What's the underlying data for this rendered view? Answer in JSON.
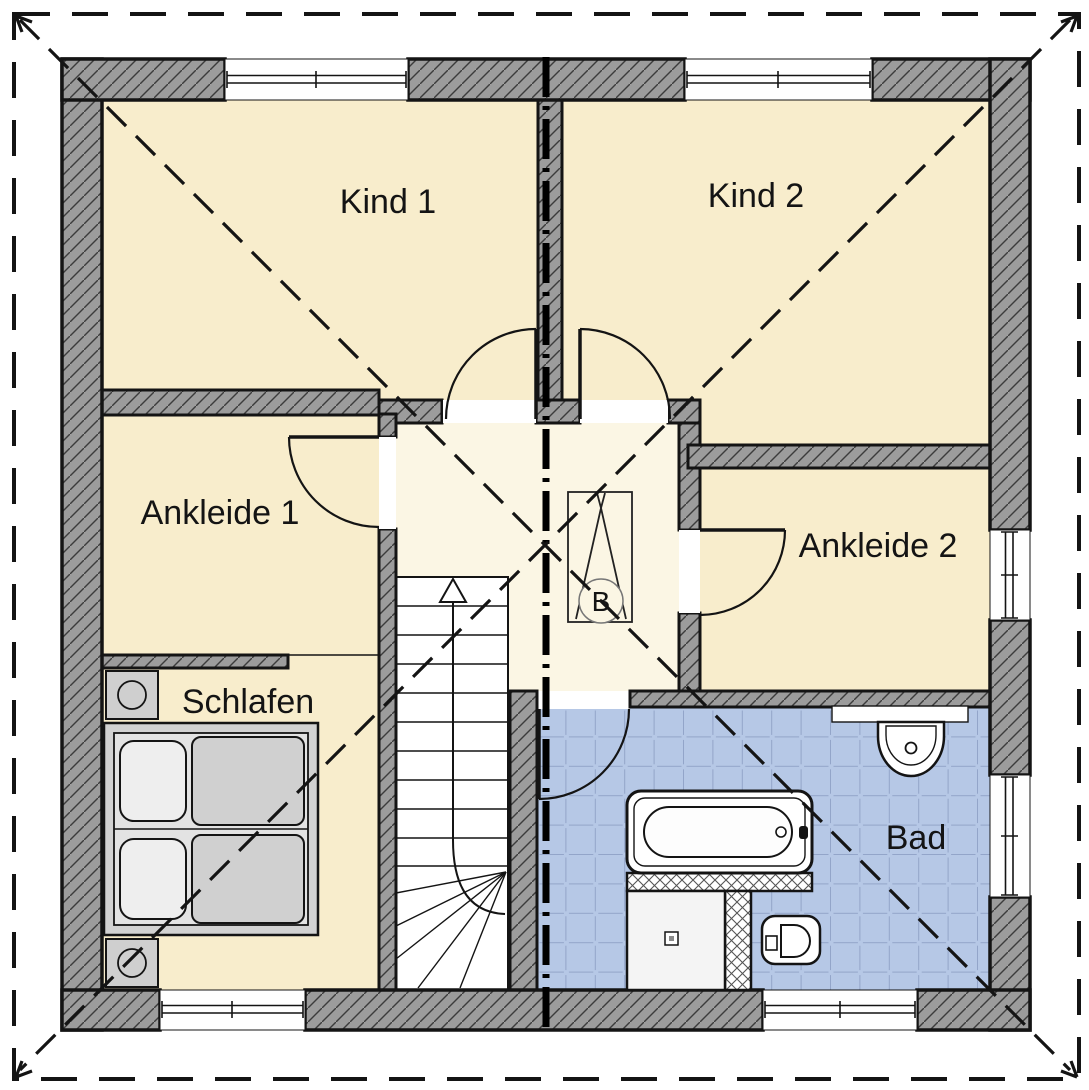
{
  "plan": {
    "type": "floorplan-upper-storey",
    "rooms": {
      "kind1": "Kind 1",
      "kind2": "Kind 2",
      "ankleide1": "Ankleide 1",
      "ankleide2": "Ankleide 2",
      "schlafen": "Schlafen",
      "bad": "Bad"
    },
    "chimney_label": "B",
    "colors": {
      "room_fill": "#f8edcc",
      "hall_fill": "#fbf6e4",
      "tile_fill": "#b6c8e6",
      "tile_line": "#93a5c9",
      "wall_fill": "#9c9c9c",
      "hatch_line": "#3c3c3c",
      "furniture_fill": "#d2d2d2",
      "line": "#141414"
    }
  }
}
